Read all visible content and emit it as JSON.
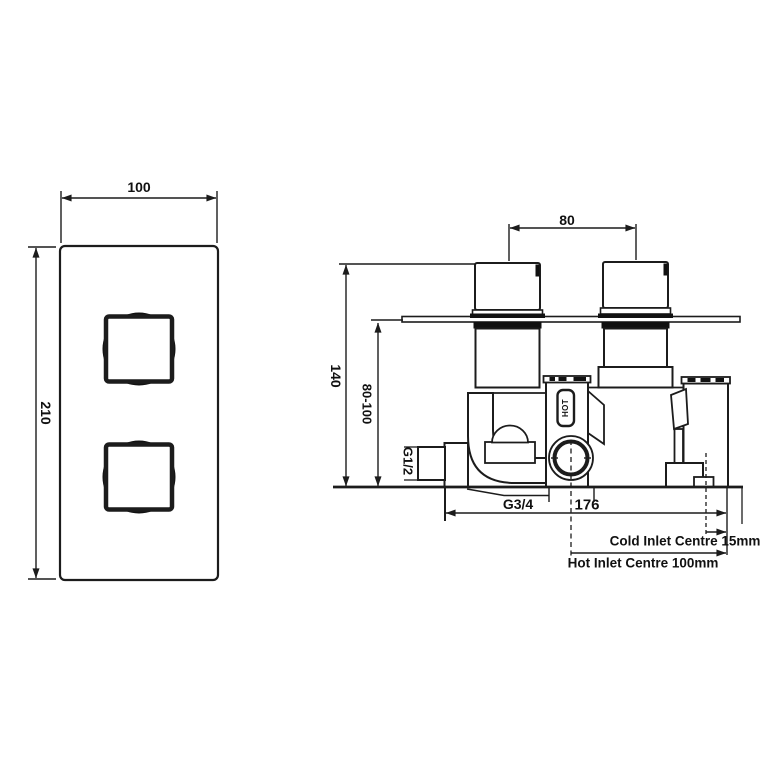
{
  "drawing": {
    "front_view": {
      "width_dim": "100",
      "height_dim": "210"
    },
    "side_view": {
      "handle_centres_dim": "80",
      "height_dim": "140",
      "depth_range_dim": "80-100",
      "inlet_thread": "G1/2",
      "outlet_thread": "G3/4",
      "body_width_dim": "176",
      "hot_marking": "HOT"
    },
    "notes": {
      "cold_inlet": "Cold Inlet Centre 15mm",
      "hot_inlet": "Hot Inlet Centre 100mm"
    },
    "colors": {
      "line": "#1c1c1c",
      "background": "#ffffff"
    }
  }
}
